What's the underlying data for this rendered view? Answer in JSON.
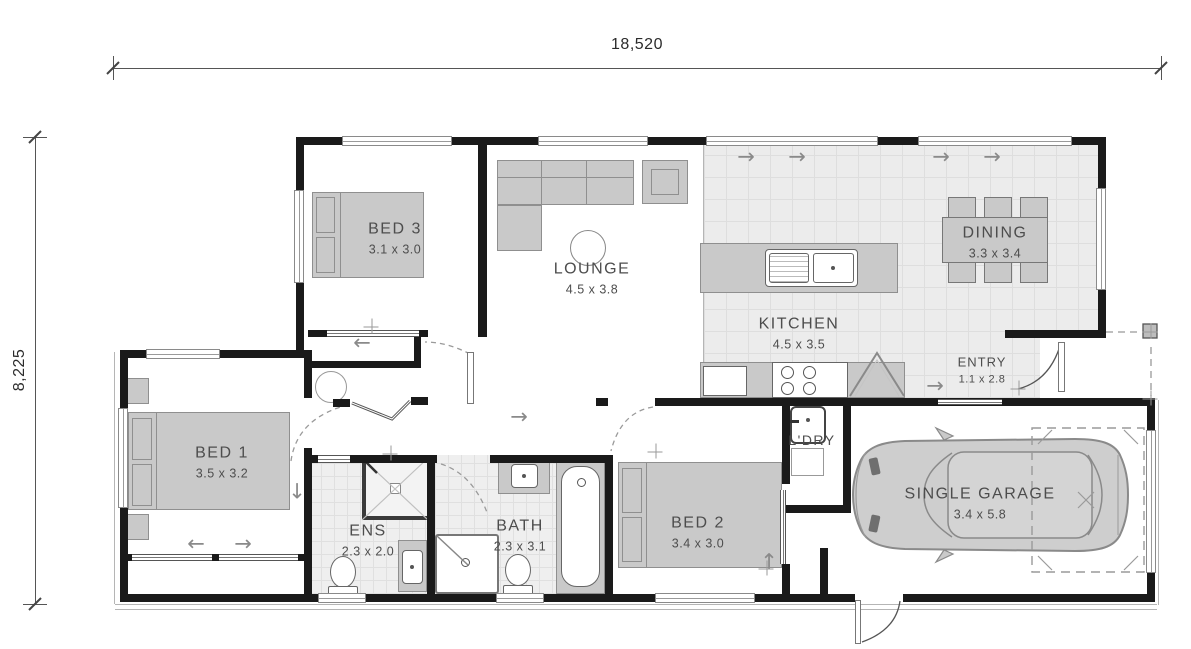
{
  "plan": {
    "type": "residential floor plan"
  },
  "dimensions": {
    "width_label": "18,520",
    "height_label": "8,225"
  },
  "rooms": [
    {
      "id": "bed3",
      "name": "BED 3",
      "dims": "3.1 x 3.0"
    },
    {
      "id": "lounge",
      "name": "LOUNGE",
      "dims": "4.5 x 3.8"
    },
    {
      "id": "kitchen",
      "name": "KITCHEN",
      "dims": "4.5 x 3.5"
    },
    {
      "id": "dining",
      "name": "DINING",
      "dims": "3.3 x 3.4"
    },
    {
      "id": "entry",
      "name": "ENTRY",
      "dims": "1.1 x 2.8"
    },
    {
      "id": "bed1",
      "name": "BED 1",
      "dims": "3.5 x 3.2"
    },
    {
      "id": "ens",
      "name": "ENS",
      "dims": "2.3 x 2.0"
    },
    {
      "id": "bath",
      "name": "BATH",
      "dims": "2.3 x 3.1"
    },
    {
      "id": "bed2",
      "name": "BED 2",
      "dims": "3.4 x 3.0"
    },
    {
      "id": "ldry",
      "name": "L'DRY",
      "dims": ""
    },
    {
      "id": "garage",
      "name": "SINGLE GARAGE",
      "dims": "3.4 x 5.8"
    }
  ],
  "icons": {
    "arrow_right": "→",
    "arrow_left": "←",
    "arrow_up": "↑",
    "arrow_down": "↓"
  },
  "colors": {
    "wall": "#1a1a1a",
    "furniture": "#c9c9c9",
    "tile": "#ececec",
    "label": "#4d4d4d",
    "dimension": "#2b2b2b",
    "door_swing": "#9a9a9a"
  }
}
